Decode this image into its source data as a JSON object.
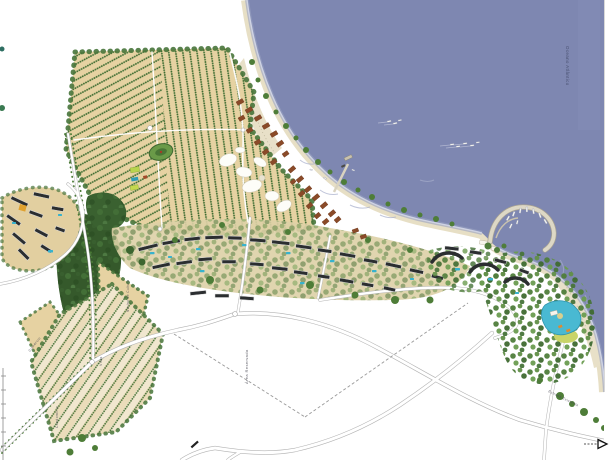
{
  "map": {
    "labels": {
      "ocean": "Oceano Atlântico",
      "reserved_area": "Área Reservada",
      "vilas": "Vilas",
      "nucleo_cultura": "Núcleo de Cultura",
      "comercio": "Comércio",
      "condominio": "Condomínio",
      "estrada": "Estrada Existente"
    },
    "colors": {
      "ocean": "#7e87b1",
      "sand": "#e7dfc5",
      "orchard": "#e6d2a2",
      "orchard_south": "#ebdcba",
      "forest": "#35592b",
      "canopy": "#578540",
      "building": "#2b2e30",
      "village_roof": "#8a4a28",
      "pool": "#37b2cd",
      "road": "#ffffff",
      "road_edge": "#b3b3b3"
    }
  }
}
